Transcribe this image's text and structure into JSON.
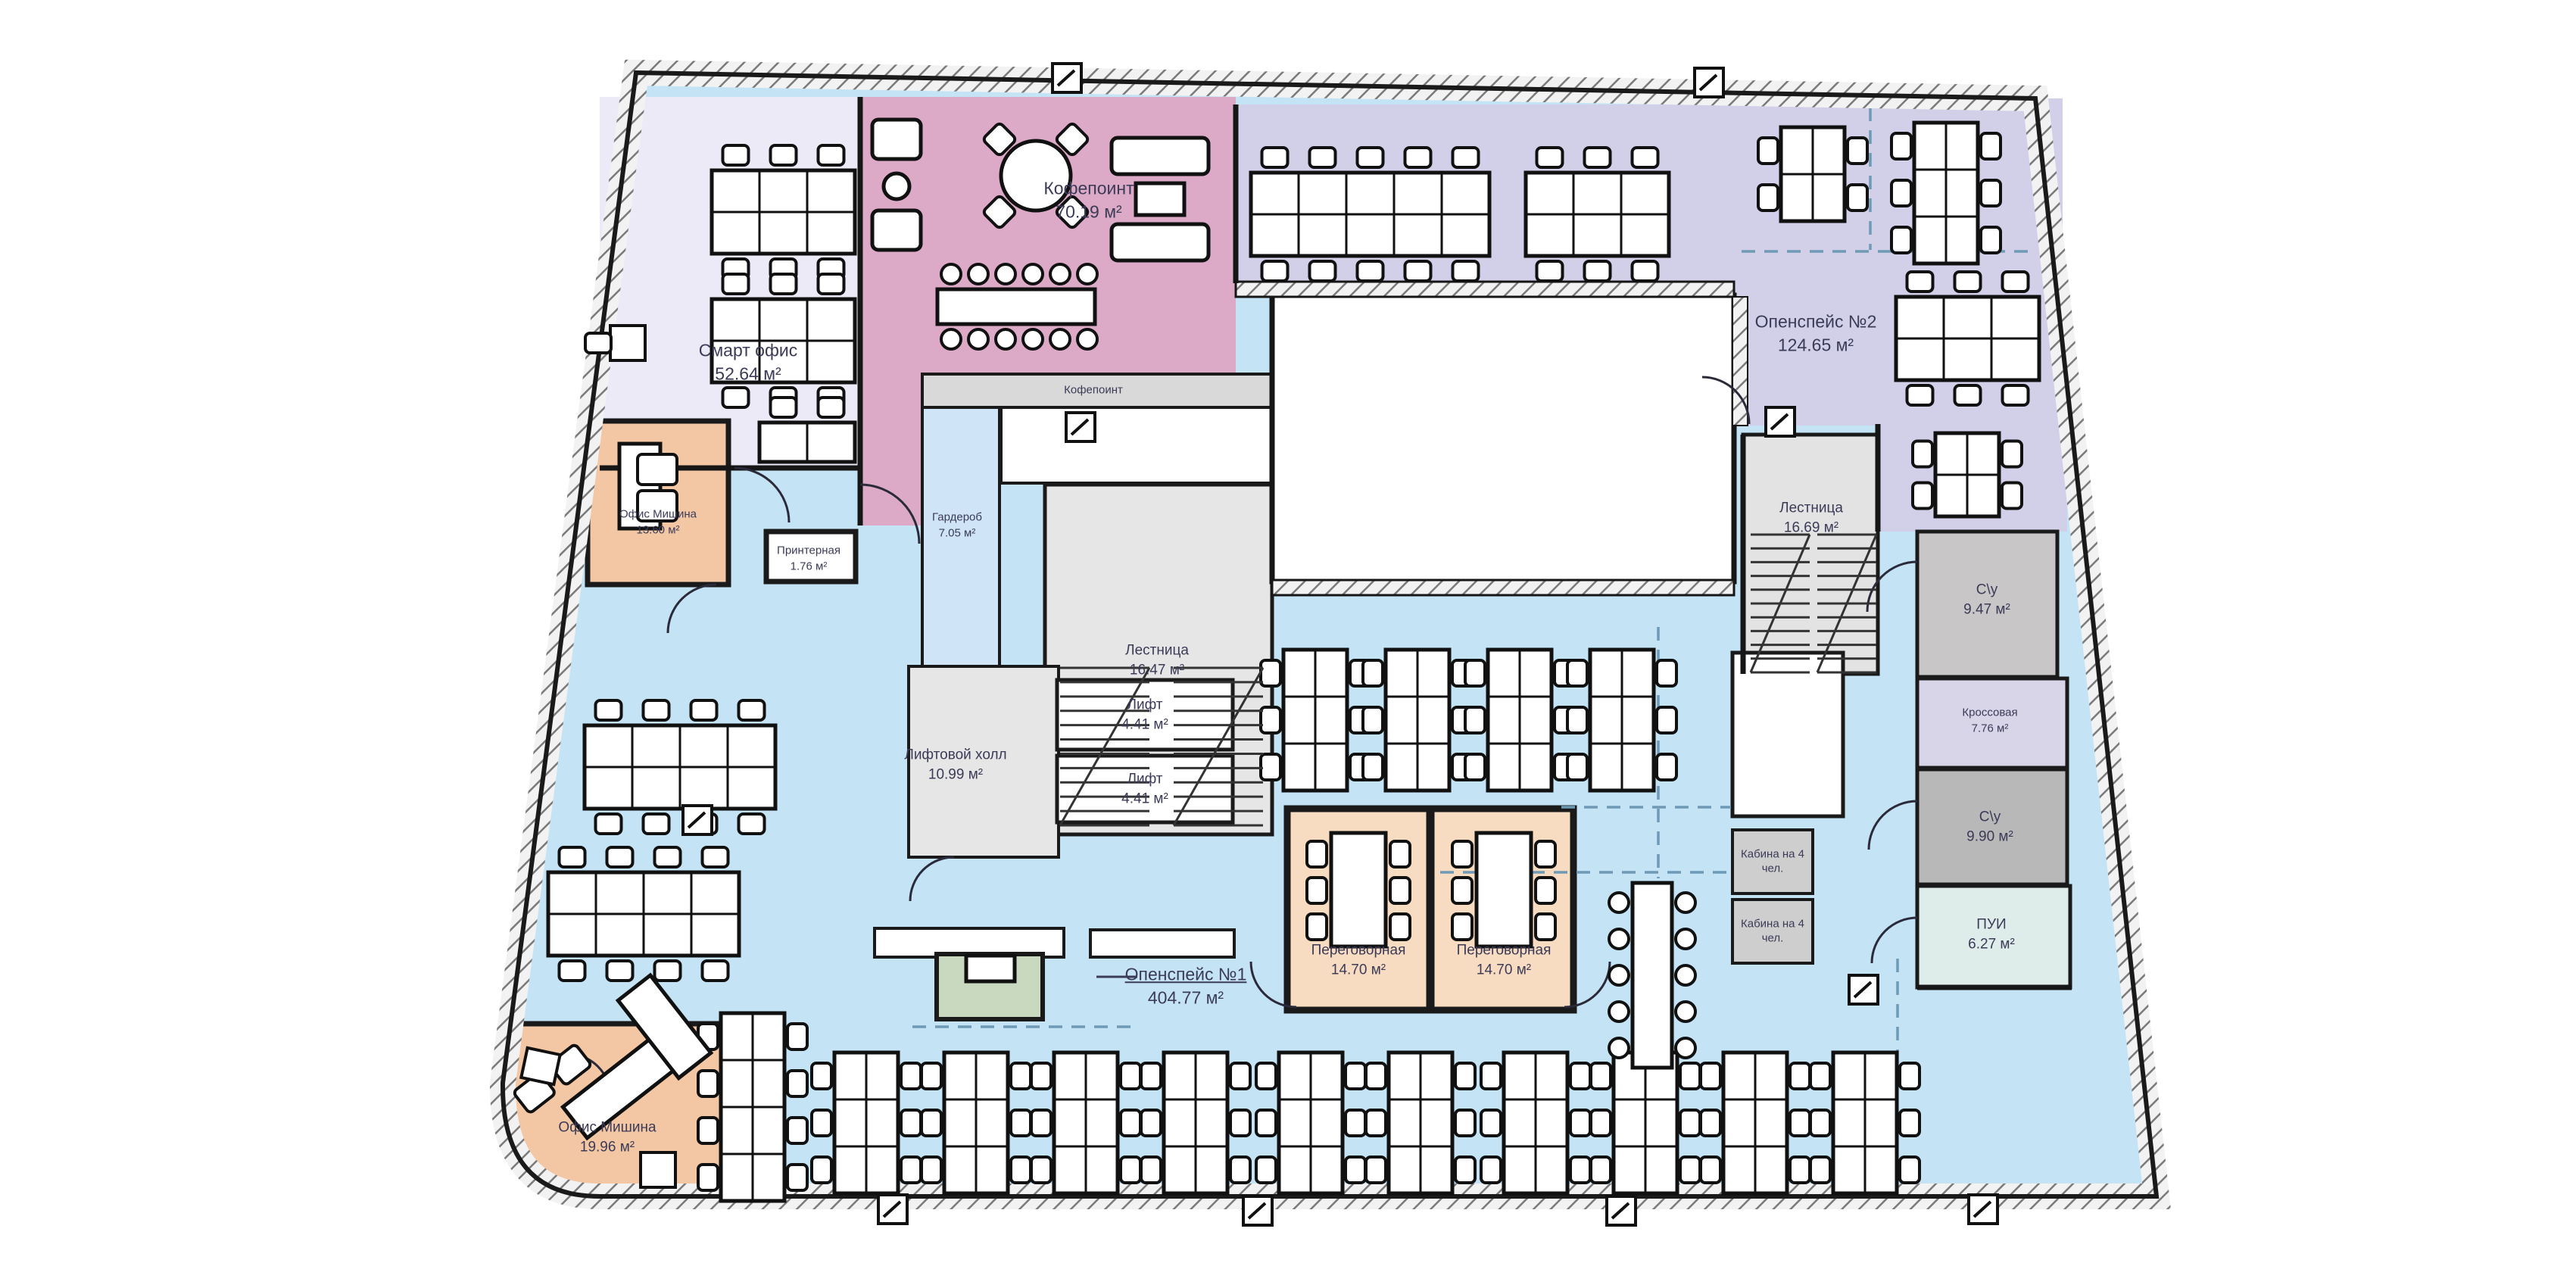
{
  "plan_title": "Office floor plan",
  "units_note": "м²",
  "colors": {
    "openspace_blue": "#c4e4f6",
    "smart_office_lavender": "#eceaf7",
    "openspace2_periwinkle": "#d2d0e9",
    "coffee_pink": "#dcaac6",
    "meeting_peach": "#f8dcc2",
    "office_peach": "#f3c7a4",
    "service_gray": "#e3e3e3",
    "wc_gray": "#c8c6c6",
    "wc_dark_gray": "#b9b8b8",
    "cross_lavender": "#d7d5e7",
    "pui_mint": "#deecea",
    "reception_green": "#c9d9c0",
    "wall": "#1a1a1a",
    "label_text": "#3b3b58",
    "zone_dash": "#6f9ab5"
  },
  "rooms": {
    "smart_office": {
      "label": "Смарт офис",
      "area": "52.64 м²"
    },
    "office_top": {
      "label": "Офис Мишина",
      "area": "13.60 м²"
    },
    "coffee_point": {
      "label": "Кофепоинт",
      "area": "70.19 м²"
    },
    "coffee_bar": {
      "label": "Кофепоинт"
    },
    "wardrobe": {
      "label": "Гардероб",
      "area": "7.05 м²"
    },
    "printer": {
      "label": "Принтерная",
      "area": "1.76 м²"
    },
    "stairs_left": {
      "label": "Лестница",
      "area": "16.47 м²"
    },
    "lift1": {
      "label": "Лифт",
      "area": "4.41 м²"
    },
    "lift2": {
      "label": "Лифт",
      "area": "4.41 м²"
    },
    "lift_hall": {
      "label": "Лифтовой холл",
      "area": "10.99 м²"
    },
    "openspace2": {
      "label": "Опенспейс №2",
      "area": "124.65 м²"
    },
    "stairs_right": {
      "label": "Лестница",
      "area": "16.69 м²"
    },
    "wc1": {
      "label": "С\\у",
      "area": "9.47 м²"
    },
    "cross_room": {
      "label": "Кроссовая",
      "area": "7.76 м²"
    },
    "wc2": {
      "label": "С\\у",
      "area": "9.90 м²"
    },
    "pui": {
      "label": "ПУИ",
      "area": "6.27 м²"
    },
    "openspace1": {
      "label": "Опенспейс №1",
      "area": "404.77 м²"
    },
    "meeting1": {
      "label": "Переговорная",
      "area": "14.70 м²"
    },
    "meeting2": {
      "label": "Переговорная",
      "area": "14.70 м²"
    },
    "cabin1": {
      "label": "Кабина на 4 чел."
    },
    "cabin2": {
      "label": "Кабина на 4 чел."
    },
    "office_bottom": {
      "label": "Офис Мишина",
      "area": "19.96 м²"
    }
  }
}
